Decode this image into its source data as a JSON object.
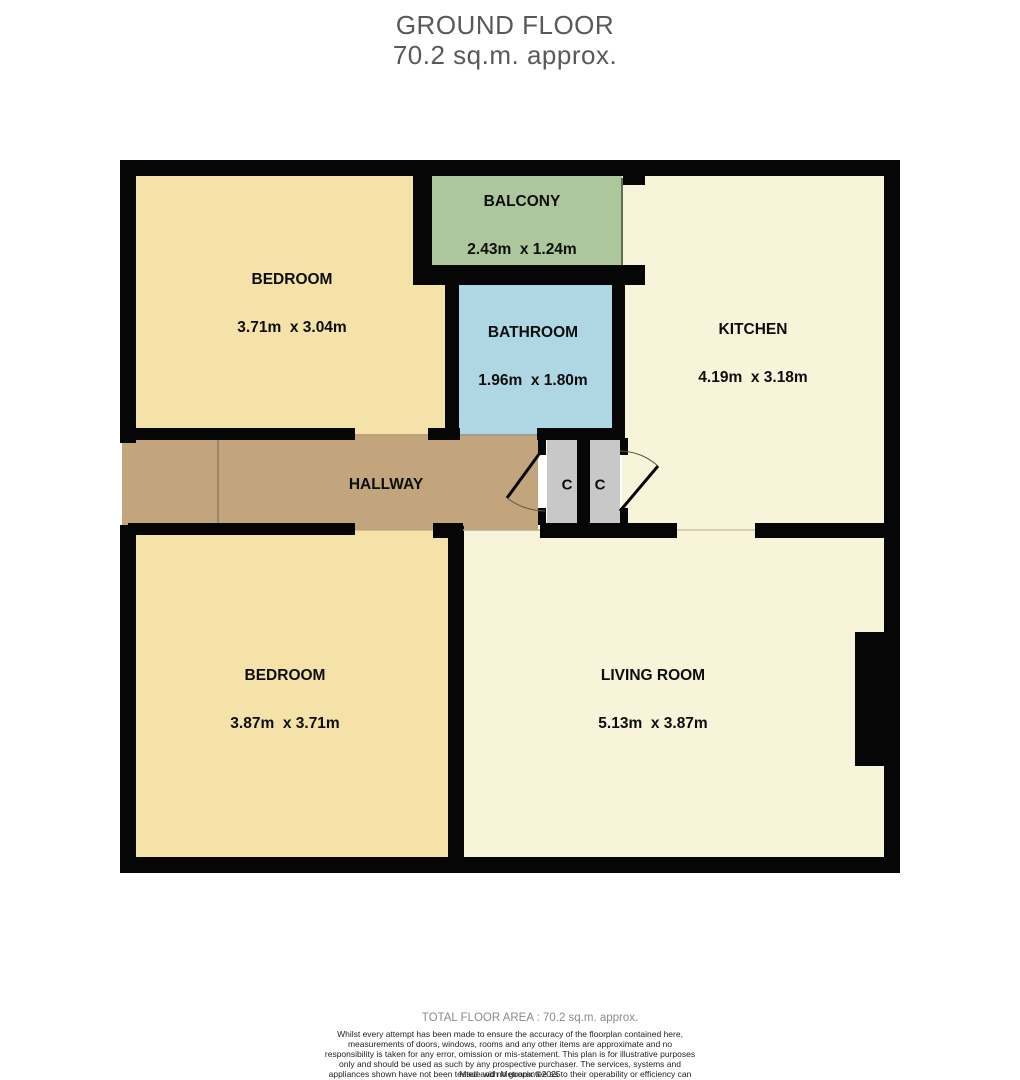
{
  "title": {
    "line1": "GROUND FLOOR",
    "line2": "70.2 sq.m. approx."
  },
  "rooms": [
    {
      "id": "bedroom-top",
      "name": "BEDROOM",
      "dims": "3.71m  x 3.04m"
    },
    {
      "id": "balcony",
      "name": "BALCONY",
      "dims": "2.43m  x 1.24m"
    },
    {
      "id": "bathroom",
      "name": "BATHROOM",
      "dims": "1.96m  x 1.80m"
    },
    {
      "id": "kitchen",
      "name": "KITCHEN",
      "dims": "4.19m  x 3.18m"
    },
    {
      "id": "hallway",
      "name": "HALLWAY",
      "dims": ""
    },
    {
      "id": "closet-left",
      "name": "C",
      "dims": ""
    },
    {
      "id": "closet-right",
      "name": "C",
      "dims": ""
    },
    {
      "id": "bedroom-bottom",
      "name": "BEDROOM",
      "dims": "3.87m  x 3.71m"
    },
    {
      "id": "living-room",
      "name": "LIVING ROOM",
      "dims": "5.13m  x 3.87m"
    }
  ],
  "footer": {
    "total": "TOTAL FLOOR AREA : 70.2 sq.m. approx.",
    "disclaimer": "Whilst every attempt has been made to ensure the accuracy of the floorplan contained here, measurements of doors, windows, rooms and any other items are approximate and no responsibility is taken for any error, omission or mis-statement. This plan is for illustrative purposes only and should be used as such by any prospective purchaser. The services, systems and appliances shown have not been tested and no guarantee as to their operability or efficiency can be given.",
    "credit": "Made with Metropix ©2025"
  },
  "colors": {
    "wall": "#060606",
    "bedroom_fill": "#f5e2a9",
    "balcony_fill": "#abc79b",
    "bathroom_fill": "#aed7e3",
    "kitchen_living_fill": "#f8f4da",
    "hallway_fill": "#c2a57d",
    "closet_fill": "#c8c8c8",
    "title_text": "#595959",
    "footer_total_text": "#8a8a8a"
  }
}
